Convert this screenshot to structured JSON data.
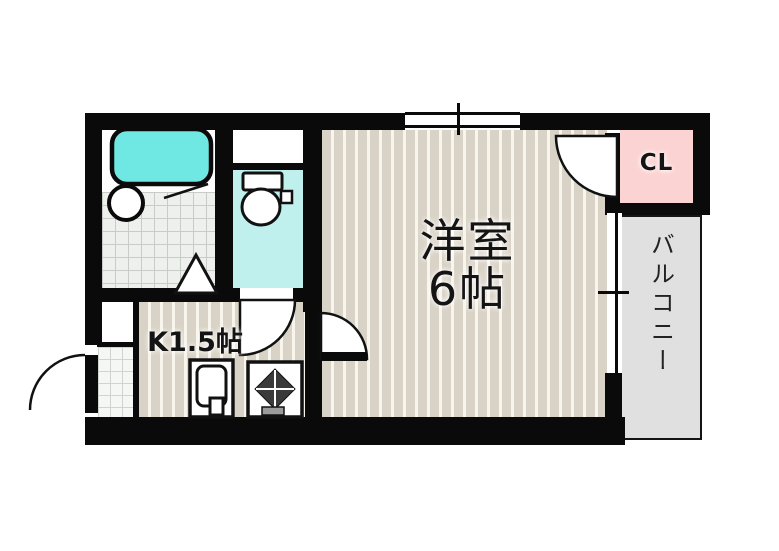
{
  "plan": {
    "rooms": {
      "western_room": {
        "name": "洋室",
        "size": "6帖"
      },
      "kitchen": {
        "label": "K1.5帖"
      },
      "closet": {
        "label": "CL"
      },
      "balcony": {
        "label": "バルコニー"
      }
    },
    "fixtures": [
      "bathtub",
      "washbasin",
      "toilet",
      "folding-door",
      "kitchen-sink",
      "gas-stove"
    ],
    "colors": {
      "wall": "#0a0a0a",
      "bathtub": "#6fe8e3",
      "toilet_floor": "#bff0ee",
      "closet_fill": "#fbd3d2",
      "balcony_fill": "#e0e0e0",
      "floor_stripe": "#d9d2c6"
    }
  }
}
